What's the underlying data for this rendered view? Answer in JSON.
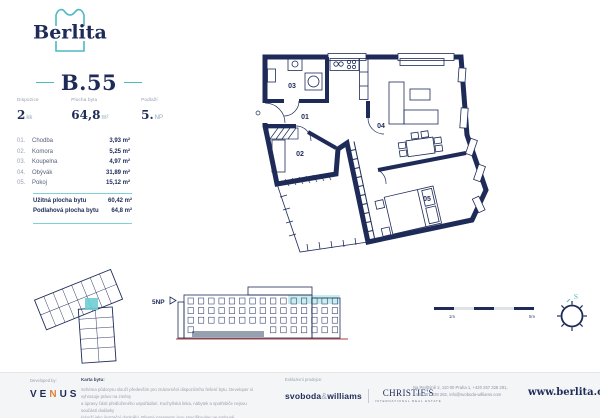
{
  "brand": {
    "logo_text": "Berlita"
  },
  "unit": {
    "id": "B.55",
    "specs": [
      {
        "label": "Dispozice",
        "value": "2",
        "suffix": "kk"
      },
      {
        "label": "Plocha bytu",
        "value": "64,8",
        "suffix": "m²"
      },
      {
        "label": "Podlaží",
        "value": "5.",
        "suffix": "NP"
      }
    ],
    "rooms": [
      {
        "no": "01.",
        "name": "Chodba",
        "area": "3,93 m²"
      },
      {
        "no": "02.",
        "name": "Komora",
        "area": "5,25 m²"
      },
      {
        "no": "03.",
        "name": "Koupelna",
        "area": "4,97 m²"
      },
      {
        "no": "04.",
        "name": "Obývák",
        "area": "31,89 m²"
      },
      {
        "no": "05.",
        "name": "Pokoj",
        "area": "15,12 m²"
      }
    ],
    "totals": [
      {
        "label": "Užitná plocha bytu",
        "value": "60,42 m²"
      },
      {
        "label": "Podlahová plocha bytu",
        "value": "64,8 m²"
      }
    ]
  },
  "floor_plan": {
    "labels": {
      "r01": "01",
      "r02": "02",
      "r03": "03",
      "r04": "04",
      "r05": "05"
    }
  },
  "elevation": {
    "floor_label": "5NP"
  },
  "scale_bar": {
    "label_start": "1m",
    "label_end": "5m"
  },
  "compass": {
    "north": "S"
  },
  "footer": {
    "developed_by": "Developed by:",
    "developer": {
      "part1": "VE",
      "part2": "N",
      "part3": "US"
    },
    "card_label": "Karta bytu:",
    "disclaimer": [
      "Schéma půdorysu slouží především pro znázornění dispozičního řešení bytu. Developer si vyhrazuje právo na změny",
      "a úpravy části předloženého uspořádání. Kuchyňská linka, nábytek a spotřebiče nejsou součástí dodávky",
      "(slouží jako ilustrační doplněk). Přesné parametry jsou specifikovány ve smlouvě."
    ],
    "broker_label": "Exkluzivní prodejce:",
    "broker_primary": "svoboda",
    "broker_amp": "&",
    "broker_secondary": "williams",
    "broker_partner": "CHRISTIE'S",
    "broker_partner_sub": "INTERNATIONAL REAL ESTATE",
    "contact_line1": "Na Perštýně 2, 110 00 Praha 1, +420 257 328 281,",
    "contact_line2": "+420 257 328 282, info@svoboda-williams.com",
    "website": "www.berlita.cz"
  },
  "colors": {
    "navy": "#1e2b58",
    "teal": "#4bbac2",
    "teal_rule": "#7ed1d6",
    "highlight_cyan": "#c7edef",
    "orange": "#e0823c",
    "ground_red": "#b23b36"
  }
}
